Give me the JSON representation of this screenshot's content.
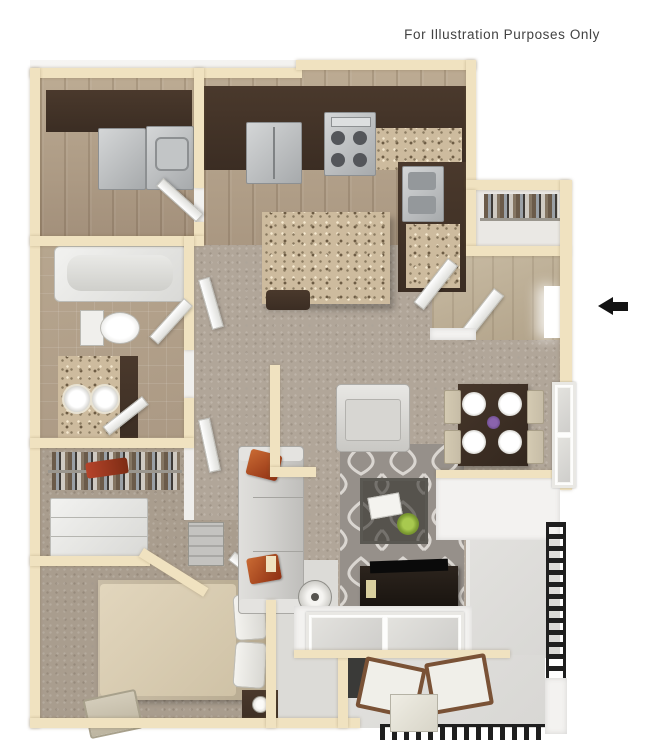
{
  "disclaimer": "For Illustration Purposes Only",
  "annotations": {
    "entry_arrow_direction": "left"
  },
  "palette": {
    "wall": "#f0e2c0",
    "wall_edge": "#fbf3dd",
    "face": "#f3f2f0",
    "shade": "#dcdbd7",
    "wood": "#a3907b",
    "wood_light": "#bcab93",
    "carpet": "#b1a699",
    "carpet_bed": "#a99d8e",
    "tile": "#ab9984",
    "dark_cab": "#3b2d23",
    "granite": "#cdbb9e",
    "steel": "#b9bcbe",
    "rug": "#96908a",
    "rug_pattern": "#dad6d1",
    "sofa": "#d5d4d1",
    "pillow": "#b3502d",
    "table_dark": "#33271e",
    "chair_beige": "#c7bda7",
    "concrete": "#d8d7d4",
    "railing": "#1f1f1f",
    "arrow": "#131313",
    "text": "#424242"
  }
}
